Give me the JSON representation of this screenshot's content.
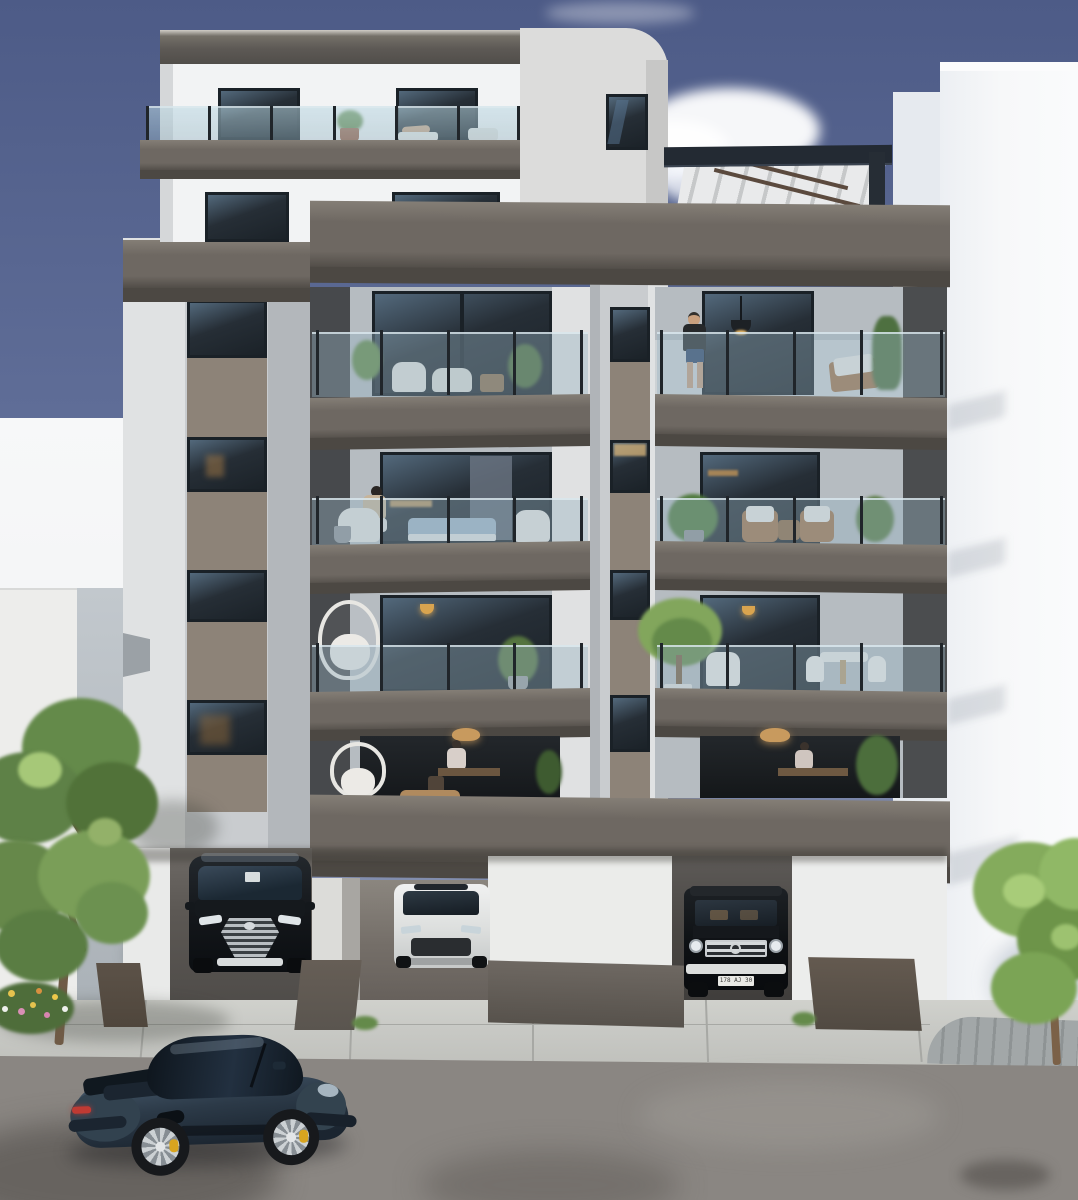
{
  "scene": {
    "kind": "photorealistic architectural exterior rendering",
    "time_of_day": "daytime, clear sky with one cloud",
    "subject": "modern six-storey apartment building with stacked dark balconies, rooftop pergola terrace, carport parking with three SUVs and a sports car parked on the street"
  },
  "palette": {
    "sky_top": "#4d5b87",
    "sky_mid": "#5f6d97",
    "sky_low": "#98a1bc",
    "white_lit": "#f2f3f4",
    "white_bright": "#f7f8f9",
    "white_shade": "#e6eaef",
    "facade_light": "#c9cccf",
    "facade_mid": "#b3b7bb",
    "facade_lit": "#e0e2e3",
    "concrete_tower": "#dcdcdb",
    "band_top": "#847e76",
    "band_face": "#6e6862",
    "band_dark": "#4c4843",
    "dark_wall": "#47494c",
    "spandrel": "#8d8378",
    "glass": "#262e36",
    "glass_frame": "#1a2127",
    "glass_hi": "#53697c",
    "rail_glass": "rgba(150,178,192,0.40)",
    "rail_post": "#20252a",
    "interior_back": "#b6bcc1",
    "interior_back_lo": "#cdd2d5",
    "warm_light": "#d9a44f",
    "wood": "#a0744c",
    "cushion": "#e9e8e4",
    "sofa_blue": "#9fb4c7",
    "green_dark": "#4c6c3a",
    "green_mid": "#648a4a",
    "green_light": "#82a65c",
    "green_pale": "#a6c878",
    "trunk": "#6f5a46",
    "pergola_steel": "#232a33",
    "pergola_slat": "#e9eaeb",
    "pergola_slat_dark": "#c6c8c9",
    "ground_concrete": "#c8c9c5",
    "ground_joint": "#a7a8a4",
    "paver": "#9ba0a1",
    "asphalt": "#8a8682",
    "asphalt_dark": "#6e6a66",
    "asphalt_light": "#9b9792",
    "planter_brown": "#4f463c",
    "planter_gray": "#5a554f",
    "car_black": "#14171a",
    "car_white": "#e9eaea",
    "chrome": "#c9cdd0",
    "porsche_body": "#2c3a48",
    "porsche_hi": "#45586a",
    "porsche_lo": "#1b2530",
    "porsche_glass": "#10181f",
    "caliper": "#d8a41f",
    "tail_red": "#bf3a33",
    "rim": "#ccd1d4",
    "skin": "#c9a07e",
    "shirt_dark": "#26282a",
    "shorts_blue": "#31486b",
    "sweater": "#c7b49a",
    "plate_bg": "#e9e9e5",
    "plate_text": "#3a3a38"
  },
  "building": {
    "balcony_bays": 2,
    "balcony_floors": 4,
    "features": [
      "rooftop glass-railing terrace",
      "louvered steel pergola",
      "recessed balconies with glass railings",
      "tan spandrel window columns",
      "carport with three bays"
    ]
  },
  "people": [
    {
      "where": "rooftop terrace",
      "pose": "sunbathing on lounger"
    },
    {
      "where": "top-right balcony",
      "pose": "man standing in dark t-shirt and blue shorts"
    },
    {
      "where": "third-floor left balcony",
      "pose": "woman seated in wicker chair"
    },
    {
      "where": "first-floor left interior",
      "pose": "person working at desk under pendant light"
    }
  ],
  "vehicles": {
    "porsche": {
      "type": "sports coupe",
      "color": "dark slate blue",
      "where": "street foreground",
      "wheels": "silver with yellow calipers"
    },
    "suv_left": {
      "type": "black luxury SUV",
      "where": "carport left bay"
    },
    "suv_center": {
      "type": "white performance SUV",
      "where": "carport center bay"
    },
    "gwagon": {
      "type": "black classic off-road SUV",
      "where": "carport right bay",
      "plate": "178 AJ 30"
    }
  },
  "vegetation": [
    {
      "type": "leafy street tree with flower bed",
      "where": "bottom left"
    },
    {
      "type": "young street tree",
      "where": "bottom right"
    },
    {
      "type": "balcony palms and potted plants",
      "where": "balconies"
    }
  ]
}
